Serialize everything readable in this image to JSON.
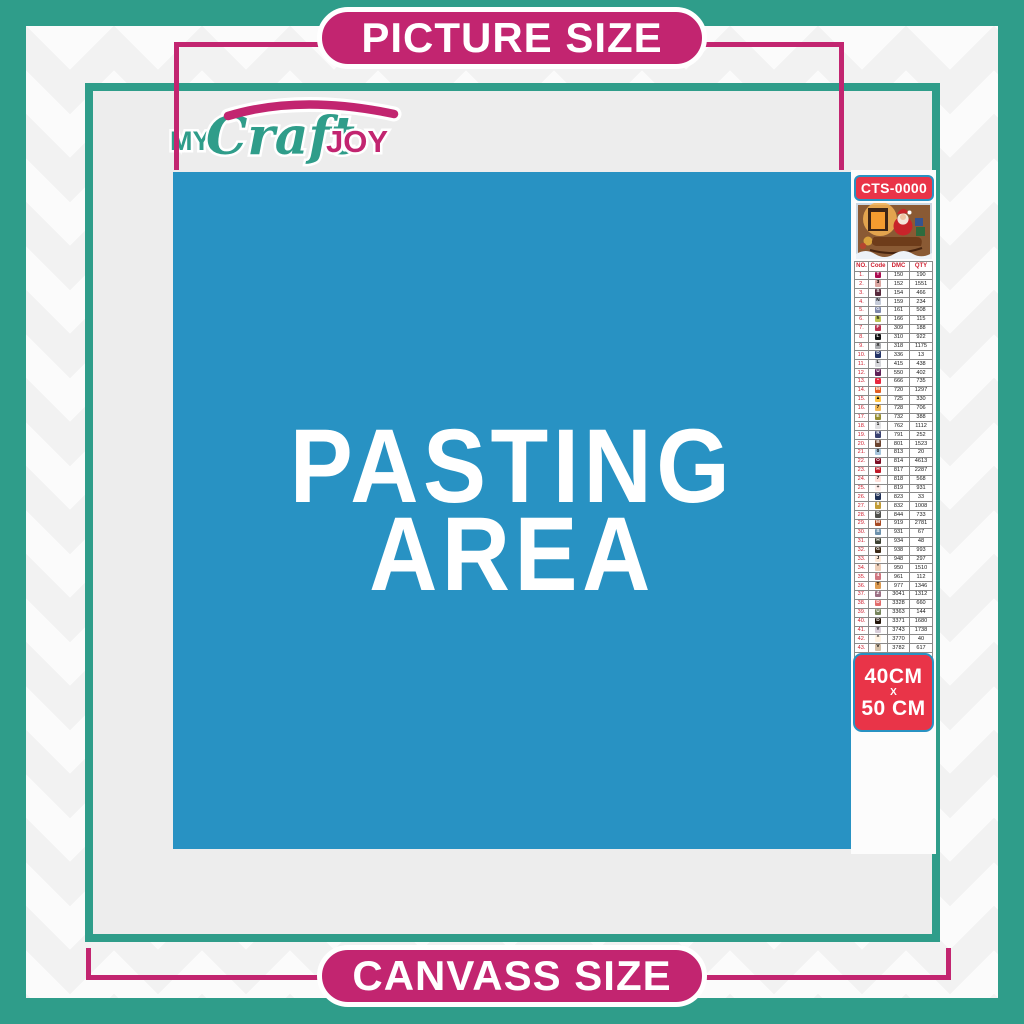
{
  "banners": {
    "top_label": "PICTURE SIZE",
    "bottom_label": "CANVASS SIZE"
  },
  "logo": {
    "word1": "MY",
    "word2": "Craft",
    "word3": "JOY"
  },
  "pasting_area": {
    "line1": "PASTING",
    "line2": "AREA"
  },
  "sidebar": {
    "product_code": "CTS-0000",
    "thumbnail": "christmas-santa-sleigh-scene",
    "size_badge": {
      "line1": "40CM",
      "line2": "X",
      "line3": "50 CM"
    },
    "table": {
      "headers": [
        "NO.",
        "Code",
        "DMC",
        "QTY"
      ],
      "rows": [
        {
          "no": "1.",
          "sym": "T",
          "bg": "#ab0d51",
          "fg": "#ffffff",
          "dmc": "150",
          "qty": "190"
        },
        {
          "no": "2.",
          "sym": "3",
          "bg": "#dca6a1",
          "fg": "#000000",
          "dmc": "152",
          "qty": "1551"
        },
        {
          "no": "3.",
          "sym": "S",
          "bg": "#57293b",
          "fg": "#ffffff",
          "dmc": "154",
          "qty": "466"
        },
        {
          "no": "4.",
          "sym": "N",
          "bg": "#c5cbd9",
          "fg": "#000000",
          "dmc": "159",
          "qty": "234"
        },
        {
          "no": "5.",
          "sym": "G",
          "bg": "#7d87ab",
          "fg": "#ffffff",
          "dmc": "161",
          "qty": "508"
        },
        {
          "no": "6.",
          "sym": "h",
          "bg": "#bdc356",
          "fg": "#000000",
          "dmc": "166",
          "qty": "115"
        },
        {
          "no": "7.",
          "sym": "F",
          "bg": "#ba314e",
          "fg": "#ffffff",
          "dmc": "309",
          "qty": "188"
        },
        {
          "no": "8.",
          "sym": "L",
          "bg": "#111111",
          "fg": "#ffffff",
          "dmc": "310",
          "qty": "922"
        },
        {
          "no": "9.",
          "sym": "X",
          "bg": "#acadb1",
          "fg": "#000000",
          "dmc": "318",
          "qty": "1175"
        },
        {
          "no": "10.",
          "sym": "D",
          "bg": "#233366",
          "fg": "#ffffff",
          "dmc": "336",
          "qty": "13"
        },
        {
          "no": "11.",
          "sym": "L",
          "bg": "#d5d6da",
          "fg": "#000000",
          "dmc": "415",
          "qty": "438"
        },
        {
          "no": "12.",
          "sym": "U",
          "bg": "#5e2157",
          "fg": "#ffffff",
          "dmc": "550",
          "qty": "402"
        },
        {
          "no": "13.",
          "sym": "•",
          "bg": "#e8263e",
          "fg": "#ffffff",
          "dmc": "666",
          "qty": "735"
        },
        {
          "no": "14.",
          "sym": "M",
          "bg": "#e35d23",
          "fg": "#ffffff",
          "dmc": "720",
          "qty": "1297"
        },
        {
          "no": "15.",
          "sym": "▲",
          "bg": "#fec445",
          "fg": "#000000",
          "dmc": "725",
          "qty": "330"
        },
        {
          "no": "16.",
          "sym": "7",
          "bg": "#f3b853",
          "fg": "#000000",
          "dmc": "728",
          "qty": "706"
        },
        {
          "no": "17.",
          "sym": "E",
          "bg": "#978d30",
          "fg": "#ffffff",
          "dmc": "732",
          "qty": "388"
        },
        {
          "no": "18.",
          "sym": "1",
          "bg": "#e0e0e2",
          "fg": "#000000",
          "dmc": "762",
          "qty": "1112"
        },
        {
          "no": "19.",
          "sym": "R",
          "bg": "#39416f",
          "fg": "#ffffff",
          "dmc": "791",
          "qty": "252"
        },
        {
          "no": "20.",
          "sym": "B",
          "bg": "#6b4430",
          "fg": "#ffffff",
          "dmc": "801",
          "qty": "1523"
        },
        {
          "no": "21.",
          "sym": "0",
          "bg": "#a7c6dd",
          "fg": "#000000",
          "dmc": "813",
          "qty": "20"
        },
        {
          "no": "22.",
          "sym": "O",
          "bg": "#7c0c23",
          "fg": "#ffffff",
          "dmc": "814",
          "qty": "4613"
        },
        {
          "no": "23.",
          "sym": "H",
          "bg": "#c01a28",
          "fg": "#ffffff",
          "dmc": "817",
          "qty": "2287"
        },
        {
          "no": "24.",
          "sym": "7",
          "bg": "#ffdfd9",
          "fg": "#000000",
          "dmc": "818",
          "qty": "568"
        },
        {
          "no": "25.",
          "sym": "+",
          "bg": "#ffeeeb",
          "fg": "#000000",
          "dmc": "819",
          "qty": "931"
        },
        {
          "no": "26.",
          "sym": "D",
          "bg": "#1f2f55",
          "fg": "#ffffff",
          "dmc": "823",
          "qty": "33"
        },
        {
          "no": "27.",
          "sym": "8",
          "bg": "#c19b35",
          "fg": "#ffffff",
          "dmc": "832",
          "qty": "1008"
        },
        {
          "no": "28.",
          "sym": "D",
          "bg": "#50504c",
          "fg": "#ffffff",
          "dmc": "844",
          "qty": "733"
        },
        {
          "no": "29.",
          "sym": "M",
          "bg": "#a74a23",
          "fg": "#ffffff",
          "dmc": "919",
          "qty": "2781"
        },
        {
          "no": "30.",
          "sym": "S",
          "bg": "#6d92ad",
          "fg": "#ffffff",
          "dmc": "931",
          "qty": "67"
        },
        {
          "no": "31.",
          "sym": "H",
          "bg": "#3c4032",
          "fg": "#ffffff",
          "dmc": "934",
          "qty": "48"
        },
        {
          "no": "32.",
          "sym": "G",
          "bg": "#3c2a17",
          "fg": "#ffffff",
          "dmc": "938",
          "qty": "993"
        },
        {
          "no": "33.",
          "sym": "J",
          "bg": "#fde9d8",
          "fg": "#000000",
          "dmc": "948",
          "qty": "297"
        },
        {
          "no": "34.",
          "sym": "*",
          "bg": "#eecfb8",
          "fg": "#000000",
          "dmc": "950",
          "qty": "1510"
        },
        {
          "no": "35.",
          "sym": "4",
          "bg": "#d0757f",
          "fg": "#ffffff",
          "dmc": "961",
          "qty": "112"
        },
        {
          "no": "36.",
          "sym": "T",
          "bg": "#dd9b51",
          "fg": "#000000",
          "dmc": "977",
          "qty": "1346"
        },
        {
          "no": "37.",
          "sym": "Z",
          "bg": "#9b7084",
          "fg": "#ffffff",
          "dmc": "3041",
          "qty": "1312"
        },
        {
          "no": "38.",
          "sym": "D",
          "bg": "#e26d6c",
          "fg": "#ffffff",
          "dmc": "3328",
          "qty": "660"
        },
        {
          "no": "39.",
          "sym": "U",
          "bg": "#77855c",
          "fg": "#ffffff",
          "dmc": "3363",
          "qty": "144"
        },
        {
          "no": "40.",
          "sym": "D",
          "bg": "#231509",
          "fg": "#ffffff",
          "dmc": "3371",
          "qty": "1680"
        },
        {
          "no": "41.",
          "sym": "Y",
          "bg": "#d9cdd8",
          "fg": "#000000",
          "dmc": "3743",
          "qty": "1738"
        },
        {
          "no": "42.",
          "sym": "^",
          "bg": "#fff3e3",
          "fg": "#000000",
          "dmc": "3770",
          "qty": "40"
        },
        {
          "no": "43.",
          "sym": "V",
          "bg": "#d3bfa7",
          "fg": "#000000",
          "dmc": "3782",
          "qty": "617"
        },
        {
          "no": "44.",
          "sym": "Z",
          "bg": "#dfe168",
          "fg": "#000000",
          "dmc": "3819",
          "qty": "119"
        },
        {
          "no": "45.",
          "sym": "✓",
          "bg": "#fdfccf",
          "fg": "#000000",
          "dmc": "3823",
          "qty": "107"
        },
        {
          "no": "46.",
          "sym": "C",
          "bg": "#f19a49",
          "fg": "#000000",
          "dmc": "3853",
          "qty": "1332"
        },
        {
          "no": "47.",
          "sym": "B",
          "bg": "#7b4a43",
          "fg": "#ffffff",
          "dmc": "3858",
          "qty": "2311"
        },
        {
          "no": "48.",
          "sym": "A",
          "bg": "#a98766",
          "fg": "#ffffff",
          "dmc": "3863",
          "qty": "1820"
        }
      ]
    }
  },
  "colors": {
    "teal": "#2f9d8a",
    "magenta": "#c22570",
    "red": "#e93448",
    "blue": "#2892c3",
    "frame_gray": "#ededed"
  }
}
